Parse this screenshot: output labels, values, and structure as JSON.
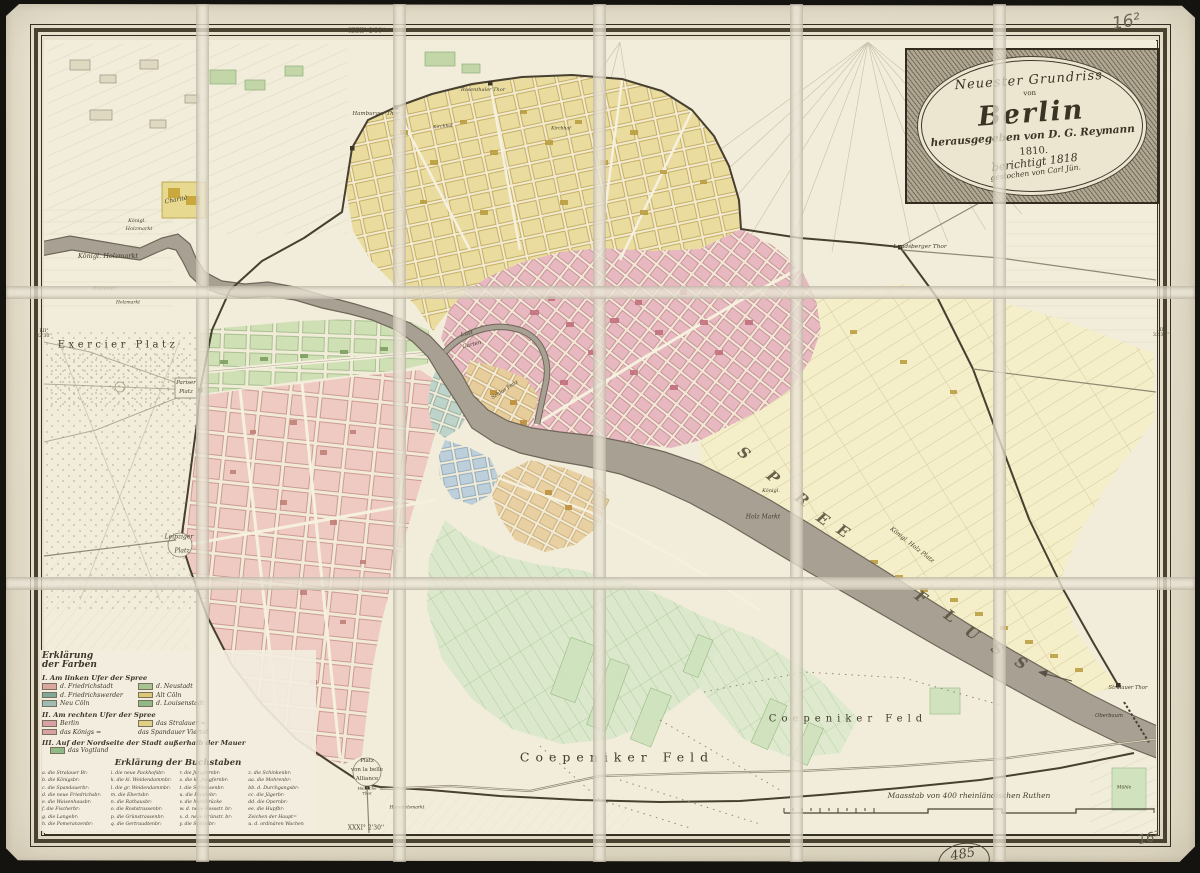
{
  "cartouche": {
    "line1": "Neuester Grundriss",
    "von": "von",
    "city": "Berlin",
    "publisher": "herausgegeben von D. G. Reymann",
    "year": "1810.",
    "revised": "berichtigt 1818",
    "engraver": "gestochen von Carl Jün."
  },
  "graticule": {
    "top": "XXXI° 2'30''",
    "bottom": "XXXI° 2'30''",
    "left": "LII° 32'30''",
    "right": "LII° 32'30''"
  },
  "annotations": {
    "top_right": "16²",
    "bottom_right": "16²",
    "stamp": "485"
  },
  "scalebar": {
    "label": "Maasstab von 400 rheinländischen Ruthen"
  },
  "legend_colors": {
    "heading1": "Erklärung",
    "heading2": "der Farben",
    "sections": [
      {
        "title": "I. Am linken Ufer der Spree",
        "entries": [
          {
            "color": "#dba8a0",
            "label": "d. Friedrichstadt"
          },
          {
            "color": "#a6c493",
            "label": "d. Neustadt"
          },
          {
            "color": "#7fa89a",
            "label": "d. Friedrichswerder"
          },
          {
            "color": "#ddc878",
            "label": "Alt Cöln"
          },
          {
            "color": "#9fbcb4",
            "label": "Neu Cöln"
          },
          {
            "color": "#8fba88",
            "label": "d. Louisenstadt"
          }
        ]
      },
      {
        "title": "II. Am rechten Ufer der Spree",
        "entries": [
          {
            "color": "#d9a0a6",
            "label": "Berlin"
          },
          {
            "color": "#e0d084",
            "label": "das Stralauer ="
          },
          {
            "color": "#d9a0a6",
            "label": "das Königs ="
          },
          {
            "color": "",
            "label": "das Spandauer Viertel"
          }
        ]
      },
      {
        "title": "III. Auf der Nordseite der Stadt außerhalb der Mauer",
        "entries": [
          {
            "color": "#8fba88",
            "label": "das Vogtland"
          }
        ]
      }
    ]
  },
  "legend_letters": {
    "heading": "Erklärung der Buchstaben",
    "columns": [
      [
        "a. die Stralauer Br:",
        "b. die Königsbr:",
        "c. die Spandauerbr:",
        "d. die neue Friedrichsbr:",
        "e. die Waisenhausbr:",
        "f. die Fischerbr:",
        "g. die Langebr:",
        "h. die Pomeranzenbr:"
      ],
      [
        "i. die neue Packhofsbr:",
        "k. die kl. Weidendammbr:",
        "l. die gr. Weidendammbr:",
        "m. die Ebertsbr:",
        "n. die Rathausbr:",
        "o. die Roststrassenbr:",
        "p. die Grünstrassenbr:",
        "q. die Gertraudtenbr:"
      ],
      [
        "r. die Jungfernbr:",
        "s. die kl. Jungfernbr:",
        "t. die Schleusenbr:",
        "u. die Hundebr:",
        "v. die Mehlbrücke",
        "w. d. neue Rossstr. br:",
        "x. d. neue Grünstr. br:",
        "y. die Spittelbr:"
      ],
      [
        "z. die Schinkenbr:",
        "aa. die Mohrenbr:",
        "bb. d. Durchgangsbr:",
        "cc. die Jägerbr:",
        "dd. die Opernbr:",
        "ee. die Hupfbr:",
        "Zeichen der Haupt=",
        "u. d. ordinären Wachen"
      ]
    ]
  },
  "map_labels": [
    {
      "t": "Exercier Platz",
      "x": 118,
      "y": 345,
      "s": 10,
      "ls": 3.5
    },
    {
      "t": "Königl. Holzmarkt",
      "x": 108,
      "y": 256,
      "s": 6.5,
      "i": 1
    },
    {
      "t": "Königl.",
      "x": 137,
      "y": 221,
      "s": 5,
      "i": 1
    },
    {
      "t": "Holzmarkt",
      "x": 139,
      "y": 229,
      "s": 5,
      "i": 1
    },
    {
      "t": "Holzplatz",
      "x": 104,
      "y": 289,
      "s": 4.8,
      "i": 1
    },
    {
      "t": "Holzmarkt",
      "x": 128,
      "y": 303,
      "s": 4.5,
      "i": 1
    },
    {
      "t": "Charité",
      "x": 176,
      "y": 200,
      "s": 6,
      "r": -10,
      "i": 1
    },
    {
      "t": "Hamburger Thor",
      "x": 376,
      "y": 114,
      "s": 5.5,
      "i": 1
    },
    {
      "t": "Rosenthaler Thor",
      "x": 483,
      "y": 90,
      "s": 5,
      "i": 1
    },
    {
      "t": "Kirchhof",
      "x": 443,
      "y": 127,
      "s": 4.5,
      "i": 1,
      "r": -6
    },
    {
      "t": "Kirchhof",
      "x": 561,
      "y": 129,
      "s": 4.5,
      "i": 1
    },
    {
      "t": "Landsberger Thor",
      "x": 920,
      "y": 247,
      "s": 5.8,
      "i": 1
    },
    {
      "t": "Pariser",
      "x": 186,
      "y": 383,
      "s": 5.5,
      "i": 1
    },
    {
      "t": "Platz",
      "x": 186,
      "y": 392,
      "s": 5.5,
      "i": 1
    },
    {
      "t": "Leipziger",
      "x": 179,
      "y": 537,
      "s": 6,
      "i": 1
    },
    {
      "t": "Platz",
      "x": 182,
      "y": 551,
      "s": 6,
      "i": 1
    },
    {
      "t": "Lust",
      "x": 467,
      "y": 334,
      "s": 5.5,
      "i": 1,
      "r": -14
    },
    {
      "t": "Garten",
      "x": 472,
      "y": 345,
      "s": 5.5,
      "i": 1,
      "r": -14
    },
    {
      "t": "Schlos Platz",
      "x": 505,
      "y": 390,
      "s": 5,
      "i": 1,
      "r": -33
    },
    {
      "t": "Platz",
      "x": 367,
      "y": 761,
      "s": 5.5
    },
    {
      "t": "von la belle",
      "x": 367,
      "y": 770,
      "s": 5.5
    },
    {
      "t": "Alliance",
      "x": 367,
      "y": 779,
      "s": 5.5
    },
    {
      "t": "Hallische",
      "x": 367,
      "y": 788,
      "s": 4
    },
    {
      "t": "Thor",
      "x": 367,
      "y": 793,
      "s": 4
    },
    {
      "t": "Coepeniker Feld",
      "x": 617,
      "y": 757,
      "s": 12.5,
      "ls": 6
    },
    {
      "t": "Coepeniker Feld",
      "x": 848,
      "y": 719,
      "s": 10,
      "ls": 5
    },
    {
      "t": "Holz Markt",
      "x": 763,
      "y": 517,
      "s": 6,
      "i": 1
    },
    {
      "t": "Königl.",
      "x": 771,
      "y": 491,
      "s": 5,
      "i": 1
    },
    {
      "t": "Königl. Holz Platz",
      "x": 912,
      "y": 545,
      "s": 6,
      "r": 38,
      "i": 1
    },
    {
      "t": "Stralauer Thor",
      "x": 1128,
      "y": 688,
      "s": 5.2,
      "i": 1
    },
    {
      "t": "Oberbaum",
      "x": 1109,
      "y": 716,
      "s": 5.2,
      "i": 1
    },
    {
      "t": "Hammelsmarkt",
      "x": 407,
      "y": 808,
      "s": 4.5,
      "i": 1
    },
    {
      "t": "Mühle",
      "x": 1124,
      "y": 788,
      "s": 4.5,
      "i": 1
    },
    {
      "t": "S",
      "x": 744,
      "y": 453,
      "s": 15,
      "r": 40,
      "c": "river"
    },
    {
      "t": "P",
      "x": 773,
      "y": 477,
      "s": 15,
      "r": 40,
      "c": "river"
    },
    {
      "t": "R",
      "x": 802,
      "y": 499,
      "s": 15,
      "r": 38,
      "c": "river"
    },
    {
      "t": "E",
      "x": 823,
      "y": 519,
      "s": 15,
      "r": 36,
      "c": "river"
    },
    {
      "t": "E",
      "x": 843,
      "y": 531,
      "s": 15,
      "r": 34,
      "c": "river"
    },
    {
      "t": "F",
      "x": 921,
      "y": 597,
      "s": 15,
      "r": 35,
      "c": "river"
    },
    {
      "t": "L",
      "x": 950,
      "y": 616,
      "s": 15,
      "r": 35,
      "c": "river"
    },
    {
      "t": "U",
      "x": 972,
      "y": 633,
      "s": 15,
      "r": 35,
      "c": "river"
    },
    {
      "t": "S",
      "x": 997,
      "y": 649,
      "s": 15,
      "r": 35,
      "c": "river"
    },
    {
      "t": "S",
      "x": 1021,
      "y": 663,
      "s": 15,
      "r": 33,
      "c": "river"
    }
  ]
}
